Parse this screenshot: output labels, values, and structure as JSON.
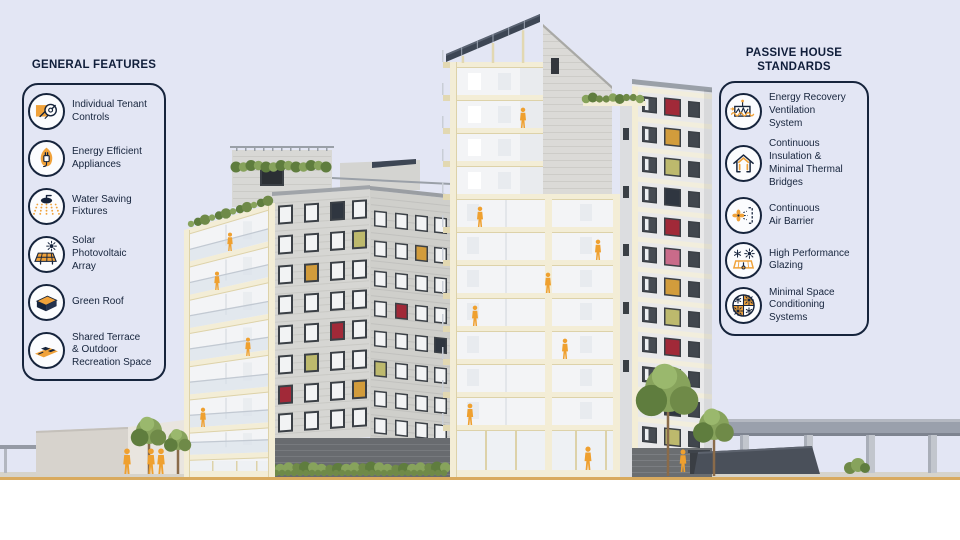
{
  "page": {
    "background_color": "#e3e6f4",
    "text_color": "#16243c",
    "accent_orange": "#f0a23a",
    "cream_structure": "#f3edd6",
    "panel_red": "#a12938",
    "panel_mustard": "#d29c3c",
    "panel_olive": "#bdb96d",
    "solar_dark": "#3d4654"
  },
  "illustration": {
    "description": "Cutaway cross-section rendering of a passive house apartment building with rooftop solar array, green roofs, trees, elevated rail viaduct and orange human figures"
  },
  "left_panel": {
    "title": "GENERAL FEATURES",
    "items": [
      {
        "icon": "tenant-controls-icon",
        "label": "Individual Tenant\nControls"
      },
      {
        "icon": "energy-efficient-appliances-icon",
        "label": "Energy Efficient\nAppliances"
      },
      {
        "icon": "water-saving-fixtures-icon",
        "label": "Water Saving\nFixtures"
      },
      {
        "icon": "solar-photovoltaic-array-icon",
        "label": "Solar\nPhotovoltaic\nArray"
      },
      {
        "icon": "green-roof-icon",
        "label": "Green Roof"
      },
      {
        "icon": "shared-terrace-icon",
        "label": "Shared Terrace\n& Outdoor\nRecreation Space"
      }
    ]
  },
  "right_panel": {
    "title": "PASSIVE HOUSE\nSTANDARDS",
    "items": [
      {
        "icon": "energy-recovery-ventilation-icon",
        "label": "Energy Recovery\nVentilation\nSystem"
      },
      {
        "icon": "continuous-insulation-icon",
        "label": "Continuous\nInsulation &\nMinimal Thermal\nBridges"
      },
      {
        "icon": "continuous-air-barrier-icon",
        "label": "Continuous\nAir Barrier"
      },
      {
        "icon": "high-performance-glazing-icon",
        "label": "High Performance\nGlazing"
      },
      {
        "icon": "minimal-space-conditioning-icon",
        "label": "Minimal Space\nConditioning\nSystems"
      }
    ]
  }
}
